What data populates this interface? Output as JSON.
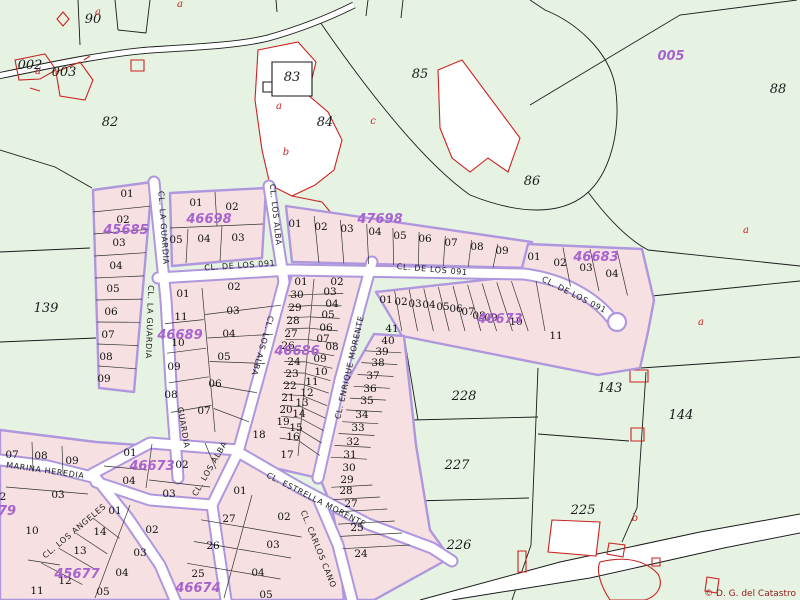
{
  "map": {
    "copyright": "© D. G. del Catastro",
    "colors": {
      "background": "#e6f3e2",
      "block_fill": "#f7e0e2",
      "block_border": "#ae97dd",
      "road_fill": "#ffffff",
      "boundary_line": "#1a1a1a",
      "feature_red": "#cc2222",
      "code_purple": "#a763ce"
    },
    "rural_parcels": [
      {
        "t": "90",
        "x": 93,
        "y": 23
      },
      {
        "t": "002",
        "x": 30,
        "y": 69,
        "fs": 11
      },
      {
        "t": "003",
        "x": 64,
        "y": 76,
        "fs": 11
      },
      {
        "t": "82",
        "x": 110,
        "y": 126
      },
      {
        "t": "83",
        "x": 292,
        "y": 81
      },
      {
        "t": "84",
        "x": 325,
        "y": 126
      },
      {
        "t": "85",
        "x": 420,
        "y": 78
      },
      {
        "t": "86",
        "x": 532,
        "y": 185
      },
      {
        "t": "88",
        "x": 778,
        "y": 93
      },
      {
        "t": "139",
        "x": 46,
        "y": 312
      },
      {
        "t": "143",
        "x": 610,
        "y": 392
      },
      {
        "t": "144",
        "x": 681,
        "y": 419
      },
      {
        "t": "228",
        "x": 464,
        "y": 400
      },
      {
        "t": "227",
        "x": 457,
        "y": 469
      },
      {
        "t": "226",
        "x": 459,
        "y": 549
      },
      {
        "t": "225",
        "x": 583,
        "y": 514
      }
    ],
    "block_codes": [
      {
        "t": "45685",
        "x": 126,
        "y": 234
      },
      {
        "t": "46698",
        "x": 209,
        "y": 223
      },
      {
        "t": "47698",
        "x": 380,
        "y": 223
      },
      {
        "t": "46683",
        "x": 596,
        "y": 261
      },
      {
        "t": "46689",
        "x": 180,
        "y": 339
      },
      {
        "t": "46686",
        "x": 297,
        "y": 355
      },
      {
        "t": "46673",
        "x": 500,
        "y": 323
      },
      {
        "t": "46673",
        "x": 152,
        "y": 470
      },
      {
        "t": "45677",
        "x": 77,
        "y": 578
      },
      {
        "t": "46674",
        "x": 198,
        "y": 592
      },
      {
        "t": "79",
        "x": 7,
        "y": 515
      },
      {
        "t": "005",
        "x": 671,
        "y": 60,
        "fs": 16
      }
    ],
    "urban_parcels": [
      {
        "t": "01",
        "x": 127,
        "y": 197
      },
      {
        "t": "02",
        "x": 123,
        "y": 223
      },
      {
        "t": "03",
        "x": 119,
        "y": 246
      },
      {
        "t": "04",
        "x": 116,
        "y": 269
      },
      {
        "t": "05",
        "x": 113,
        "y": 292
      },
      {
        "t": "06",
        "x": 111,
        "y": 315
      },
      {
        "t": "07",
        "x": 108,
        "y": 338
      },
      {
        "t": "08",
        "x": 106,
        "y": 360
      },
      {
        "t": "09",
        "x": 104,
        "y": 382
      },
      {
        "t": "01",
        "x": 196,
        "y": 206
      },
      {
        "t": "02",
        "x": 232,
        "y": 210
      },
      {
        "t": "05",
        "x": 176,
        "y": 243
      },
      {
        "t": "04",
        "x": 204,
        "y": 242
      },
      {
        "t": "03",
        "x": 238,
        "y": 241
      },
      {
        "t": "01",
        "x": 295,
        "y": 227
      },
      {
        "t": "02",
        "x": 321,
        "y": 230
      },
      {
        "t": "03",
        "x": 347,
        "y": 232
      },
      {
        "t": "04",
        "x": 375,
        "y": 235
      },
      {
        "t": "05",
        "x": 400,
        "y": 239
      },
      {
        "t": "06",
        "x": 425,
        "y": 242
      },
      {
        "t": "07",
        "x": 451,
        "y": 246
      },
      {
        "t": "08",
        "x": 477,
        "y": 250
      },
      {
        "t": "09",
        "x": 502,
        "y": 254
      },
      {
        "t": "01",
        "x": 534,
        "y": 260
      },
      {
        "t": "02",
        "x": 560,
        "y": 266
      },
      {
        "t": "03",
        "x": 586,
        "y": 271
      },
      {
        "t": "04",
        "x": 612,
        "y": 277
      },
      {
        "t": "11",
        "x": 556,
        "y": 339
      },
      {
        "t": "01",
        "x": 183,
        "y": 297
      },
      {
        "t": "11",
        "x": 181,
        "y": 320
      },
      {
        "t": "10",
        "x": 178,
        "y": 346
      },
      {
        "t": "09",
        "x": 174,
        "y": 370
      },
      {
        "t": "08",
        "x": 171,
        "y": 398
      },
      {
        "t": "02",
        "x": 234,
        "y": 290
      },
      {
        "t": "03",
        "x": 233,
        "y": 314
      },
      {
        "t": "04",
        "x": 229,
        "y": 337
      },
      {
        "t": "05",
        "x": 224,
        "y": 360
      },
      {
        "t": "06",
        "x": 215,
        "y": 387
      },
      {
        "t": "07",
        "x": 204,
        "y": 414
      },
      {
        "t": "01",
        "x": 301,
        "y": 285
      },
      {
        "t": "30",
        "x": 297,
        "y": 298
      },
      {
        "t": "29",
        "x": 295,
        "y": 311
      },
      {
        "t": "28",
        "x": 293,
        "y": 324
      },
      {
        "t": "27",
        "x": 291,
        "y": 337
      },
      {
        "t": "26",
        "x": 288,
        "y": 349
      },
      {
        "t": "24",
        "x": 294,
        "y": 365
      },
      {
        "t": "23",
        "x": 292,
        "y": 377
      },
      {
        "t": "22",
        "x": 290,
        "y": 389
      },
      {
        "t": "21",
        "x": 288,
        "y": 401
      },
      {
        "t": "20",
        "x": 286,
        "y": 413
      },
      {
        "t": "19",
        "x": 283,
        "y": 425
      },
      {
        "t": "18",
        "x": 259,
        "y": 438
      },
      {
        "t": "17",
        "x": 287,
        "y": 458
      },
      {
        "t": "02",
        "x": 337,
        "y": 285
      },
      {
        "t": "03",
        "x": 330,
        "y": 295
      },
      {
        "t": "04",
        "x": 332,
        "y": 307
      },
      {
        "t": "05",
        "x": 328,
        "y": 318
      },
      {
        "t": "06",
        "x": 326,
        "y": 331
      },
      {
        "t": "07",
        "x": 323,
        "y": 342
      },
      {
        "t": "08",
        "x": 332,
        "y": 350
      },
      {
        "t": "09",
        "x": 320,
        "y": 362
      },
      {
        "t": "10",
        "x": 321,
        "y": 375
      },
      {
        "t": "11",
        "x": 312,
        "y": 385
      },
      {
        "t": "12",
        "x": 307,
        "y": 396
      },
      {
        "t": "13",
        "x": 302,
        "y": 406
      },
      {
        "t": "14",
        "x": 299,
        "y": 417
      },
      {
        "t": "15",
        "x": 296,
        "y": 431
      },
      {
        "t": "16",
        "x": 293,
        "y": 440
      },
      {
        "t": "01",
        "x": 386,
        "y": 303
      },
      {
        "t": "02",
        "x": 401,
        "y": 305
      },
      {
        "t": "03",
        "x": 415,
        "y": 307
      },
      {
        "t": "04",
        "x": 429,
        "y": 308
      },
      {
        "t": "05",
        "x": 443,
        "y": 310
      },
      {
        "t": "06",
        "x": 456,
        "y": 312
      },
      {
        "t": "07",
        "x": 468,
        "y": 315
      },
      {
        "t": "08",
        "x": 479,
        "y": 319
      },
      {
        "t": "09",
        "x": 491,
        "y": 321
      },
      {
        "t": "10",
        "x": 516,
        "y": 325
      },
      {
        "t": "41",
        "x": 392,
        "y": 332
      },
      {
        "t": "40",
        "x": 388,
        "y": 344
      },
      {
        "t": "39",
        "x": 382,
        "y": 355
      },
      {
        "t": "38",
        "x": 378,
        "y": 366
      },
      {
        "t": "37",
        "x": 373,
        "y": 379
      },
      {
        "t": "36",
        "x": 370,
        "y": 392
      },
      {
        "t": "35",
        "x": 367,
        "y": 404
      },
      {
        "t": "34",
        "x": 362,
        "y": 418
      },
      {
        "t": "33",
        "x": 358,
        "y": 431
      },
      {
        "t": "32",
        "x": 353,
        "y": 445
      },
      {
        "t": "31",
        "x": 350,
        "y": 458
      },
      {
        "t": "30",
        "x": 349,
        "y": 471
      },
      {
        "t": "29",
        "x": 347,
        "y": 483
      },
      {
        "t": "28",
        "x": 346,
        "y": 494
      },
      {
        "t": "27",
        "x": 351,
        "y": 507
      },
      {
        "t": "25",
        "x": 357,
        "y": 531
      },
      {
        "t": "24",
        "x": 361,
        "y": 557
      },
      {
        "t": "07",
        "x": 12,
        "y": 458
      },
      {
        "t": "08",
        "x": 41,
        "y": 459
      },
      {
        "t": "09",
        "x": 72,
        "y": 464
      },
      {
        "t": "01",
        "x": 130,
        "y": 456
      },
      {
        "t": "02",
        "x": 182,
        "y": 468
      },
      {
        "t": "04",
        "x": 129,
        "y": 484
      },
      {
        "t": "03",
        "x": 169,
        "y": 497
      },
      {
        "t": "03",
        "x": 58,
        "y": 498
      },
      {
        "t": "2",
        "x": 3,
        "y": 500
      },
      {
        "t": "10",
        "x": 32,
        "y": 534
      },
      {
        "t": "11",
        "x": 37,
        "y": 594
      },
      {
        "t": "01",
        "x": 115,
        "y": 514
      },
      {
        "t": "14",
        "x": 100,
        "y": 535
      },
      {
        "t": "13",
        "x": 80,
        "y": 554
      },
      {
        "t": "12",
        "x": 65,
        "y": 584
      },
      {
        "t": "02",
        "x": 152,
        "y": 533
      },
      {
        "t": "03",
        "x": 140,
        "y": 556
      },
      {
        "t": "04",
        "x": 122,
        "y": 576
      },
      {
        "t": "05",
        "x": 103,
        "y": 595
      },
      {
        "t": "01",
        "x": 240,
        "y": 494
      },
      {
        "t": "27",
        "x": 229,
        "y": 522
      },
      {
        "t": "26",
        "x": 213,
        "y": 549
      },
      {
        "t": "25",
        "x": 198,
        "y": 577
      },
      {
        "t": "02",
        "x": 284,
        "y": 520
      },
      {
        "t": "03",
        "x": 273,
        "y": 548
      },
      {
        "t": "04",
        "x": 258,
        "y": 576
      },
      {
        "t": "05",
        "x": 266,
        "y": 598
      }
    ],
    "streets": [
      {
        "t": "CL. LA GUARDIA",
        "x": 161,
        "y": 228,
        "r": 86
      },
      {
        "t": "CL. LA GUARDIA",
        "x": 147,
        "y": 322,
        "r": 92
      },
      {
        "t": "GUARDIA",
        "x": 181,
        "y": 428,
        "r": 80
      },
      {
        "t": "CL. LOS ALBA",
        "x": 273,
        "y": 215,
        "r": 84
      },
      {
        "t": "CL. LOS ALBA",
        "x": 260,
        "y": 345,
        "r": 106
      },
      {
        "t": "CL. LOS ALBA",
        "x": 212,
        "y": 470,
        "r": -60
      },
      {
        "t": "CL. DE LOS 091",
        "x": 240,
        "y": 268,
        "r": -4
      },
      {
        "t": "CL. DE LOS 091",
        "x": 432,
        "y": 272,
        "r": 5
      },
      {
        "t": "CL. DE LOS 091",
        "x": 573,
        "y": 297,
        "r": 27
      },
      {
        "t": "CL. ENRIQUE MORENTE",
        "x": 352,
        "y": 368,
        "r": -77
      },
      {
        "t": "CL. ESTRELLA MORENTE",
        "x": 315,
        "y": 502,
        "r": 27
      },
      {
        "t": "CL. CARLOS CANO",
        "x": 316,
        "y": 550,
        "r": 68
      },
      {
        "t": "MARINA  HEREDIA",
        "x": 45,
        "y": 473,
        "r": 8
      },
      {
        "t": "CL. LOS ANGELES",
        "x": 76,
        "y": 533,
        "r": -40
      }
    ],
    "ref_letters": [
      {
        "t": "a",
        "x": 98,
        "y": 15
      },
      {
        "t": "a",
        "x": 180,
        "y": 7
      },
      {
        "t": "a",
        "x": 38,
        "y": 74
      },
      {
        "t": "a",
        "x": 279,
        "y": 109
      },
      {
        "t": "b",
        "x": 286,
        "y": 155
      },
      {
        "t": "c",
        "x": 373,
        "y": 124
      },
      {
        "t": "a",
        "x": 746,
        "y": 233
      },
      {
        "t": "a",
        "x": 701,
        "y": 325
      },
      {
        "t": "b",
        "x": 635,
        "y": 521
      }
    ]
  }
}
